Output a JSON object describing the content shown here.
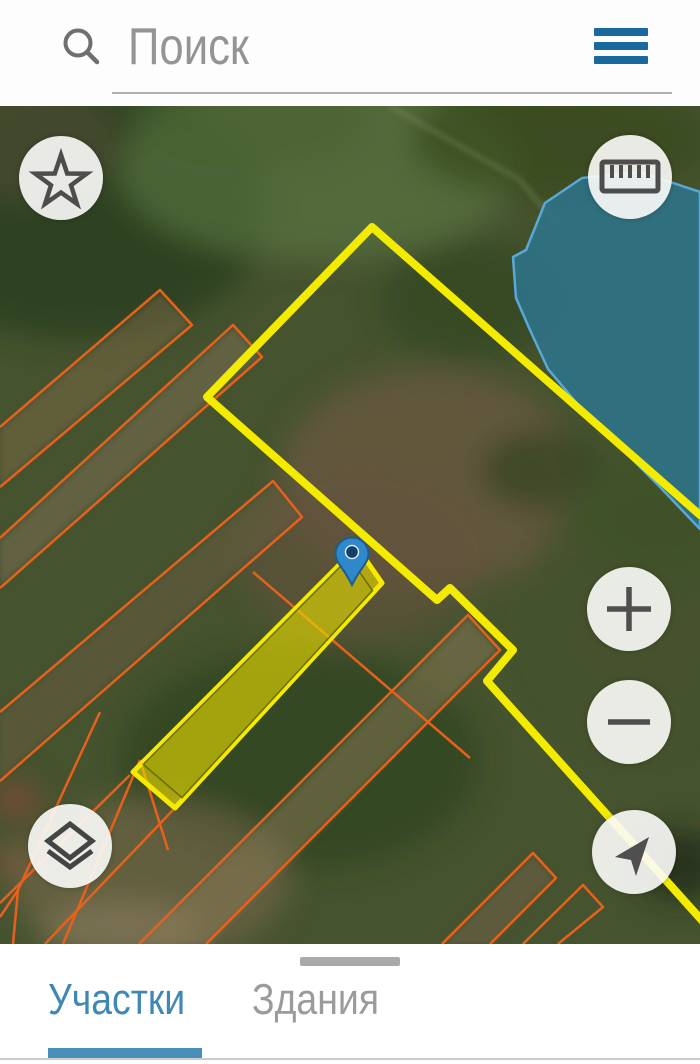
{
  "search": {
    "placeholder": "Поиск"
  },
  "tabs": [
    {
      "label": "Участки",
      "active": true
    },
    {
      "label": "Здания",
      "active": false
    }
  ],
  "icons": {
    "search": "magnifier",
    "menu": "hamburger",
    "favorites": "star",
    "measure": "ruler",
    "zoom_in": "plus",
    "zoom_out": "minus",
    "layers": "stacked-layers",
    "my_location": "navigation-arrow",
    "marker": "map-pin"
  },
  "colors": {
    "accent_blue": "#19699f",
    "tab_active_blue": "#3f88b5",
    "boundary_yellow": "#f4ec00",
    "parcel_orange": "#e8611c",
    "selected_parcel_fill": "#e6dc00",
    "water_fill": "#2e7389",
    "water_stroke": "#5aa8d8",
    "pin_blue": "#2f88c9"
  }
}
